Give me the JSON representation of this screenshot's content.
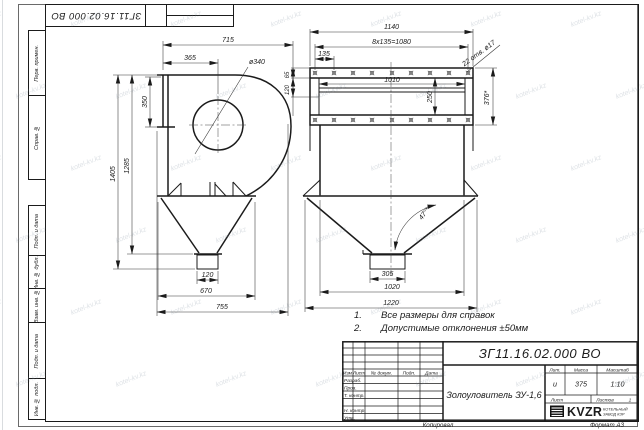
{
  "watermark": {
    "text": "kotel-kv.kz"
  },
  "corner_stamp": {
    "doc_number": "ЗГ11.16.02.000 ВО"
  },
  "sidebar": {
    "labels": [
      "Перв. примен.",
      "Справ. №",
      "Подп. и дата",
      "Инв. № дубл.",
      "Взам. инв. №",
      "Подп. и дата",
      "Инв. № подл."
    ]
  },
  "notes": {
    "items": [
      {
        "num": "1.",
        "text": "Все размеры для справок"
      },
      {
        "num": "2.",
        "text": "Допустимые отклонения ±50мм"
      }
    ]
  },
  "left_view": {
    "dim_715": "715",
    "dim_365": "365",
    "dim_dia": "ø340",
    "dim_350": "350",
    "dim_1405": "1405",
    "dim_1285": "1285",
    "dim_120": "120",
    "dim_670": "670",
    "dim_755": "755"
  },
  "right_view": {
    "dim_1140": "1140",
    "dim_pitch": "8x135=1080",
    "dim_135": "135",
    "dim_1010": "1010",
    "dim_250": "250",
    "dim_65": "65",
    "dim_120": "120",
    "holes_note": "22 отв. ø17",
    "dim_376": "376*",
    "angle": "47°*",
    "dim_305": "305",
    "dim_1020": "1020",
    "dim_1220": "1220"
  },
  "title_block": {
    "designation": "ЗГ11.16.02.000 ВО",
    "product_name": "Золоуловитель ЗУ-1,6",
    "header": {
      "izm": "Изм",
      "list": "Лист",
      "doc": "№ докум.",
      "podp": "Подп.",
      "data": "Дата"
    },
    "sign_rows": [
      "Разраб.",
      "Пров.",
      "Т. контр.",
      "",
      "Н. контр.",
      "Утв."
    ],
    "lit_label": "Лит.",
    "mass_label": "Масса",
    "scale_label": "Масштаб",
    "lit_value": "и",
    "mass_value": "375",
    "scale_value": "1:10",
    "sheet_label": "Лист",
    "sheets_label": "Листов",
    "sheets_value": "1",
    "logo_text": "KVZR",
    "logo_sub1": "КОТЕЛЬНЫЙ",
    "logo_sub2": "ЗАВОД КЗР"
  },
  "footer": {
    "copied": "Копировал",
    "format": "Формат А3"
  }
}
